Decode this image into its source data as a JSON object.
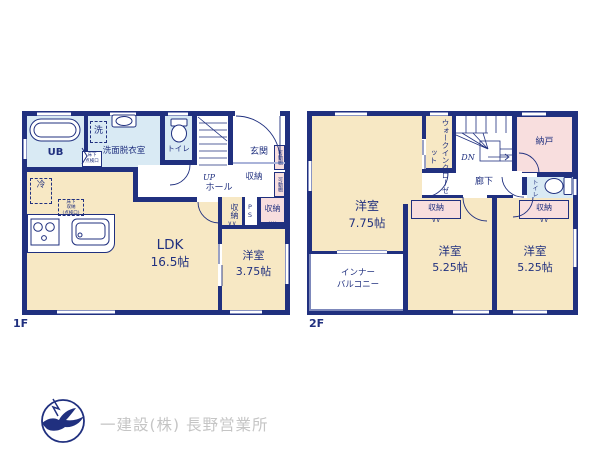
{
  "floor1": {
    "tag": "1F",
    "ub": "UB",
    "senmen": "洗面脱衣室",
    "washer": "洗",
    "tenkenko_l1": "床下",
    "tenkenko_l2": "点検口",
    "toilet": "トイレ",
    "up": "UP",
    "hall": "ホール",
    "genkan": "玄関",
    "genkan_shuno": "収納",
    "kadodana_1": "可動棚",
    "kadodana_2": "可動棚",
    "fridge": "冷",
    "yukashita_shuno_l1": "床下",
    "yukashita_shuno_l2": "収納",
    "yukashita_shuno_l3": "(点検口)",
    "ldk": "LDK",
    "ldk_size": "16.5帖",
    "shuno_tall": "収納",
    "ps": "PS",
    "shuno_pink": "収納",
    "yoshitsu": "洋室",
    "yoshitsu_size": "3.75帖"
  },
  "floor2": {
    "tag": "2F",
    "yoshitsu_main": "洋室",
    "yoshitsu_main_size": "7.75帖",
    "wic": "ウォークインクローゼット",
    "dn": "DN",
    "nando": "納戸",
    "roka": "廊下",
    "toilet": "トイレ",
    "shuno_1": "収納",
    "shuno_2": "収納",
    "balcony_l1": "インナー",
    "balcony_l2": "バルコニー",
    "yoshitsu_a": "洋室",
    "yoshitsu_a_size": "5.25帖",
    "yoshitsu_b": "洋室",
    "yoshitsu_b_size": "5.25帖"
  },
  "glyphs": {
    "closet_mark": "∨∨"
  },
  "footer": {
    "company": "一建設(株) 長野営業所"
  },
  "colors": {
    "wall": "#20307f",
    "room_cream": "#f7e8c4",
    "room_blue": "#d9eaf4",
    "room_pink": "#f8dede",
    "window_edge": "#8a94c4",
    "footer_text": "#c5c5c5"
  }
}
